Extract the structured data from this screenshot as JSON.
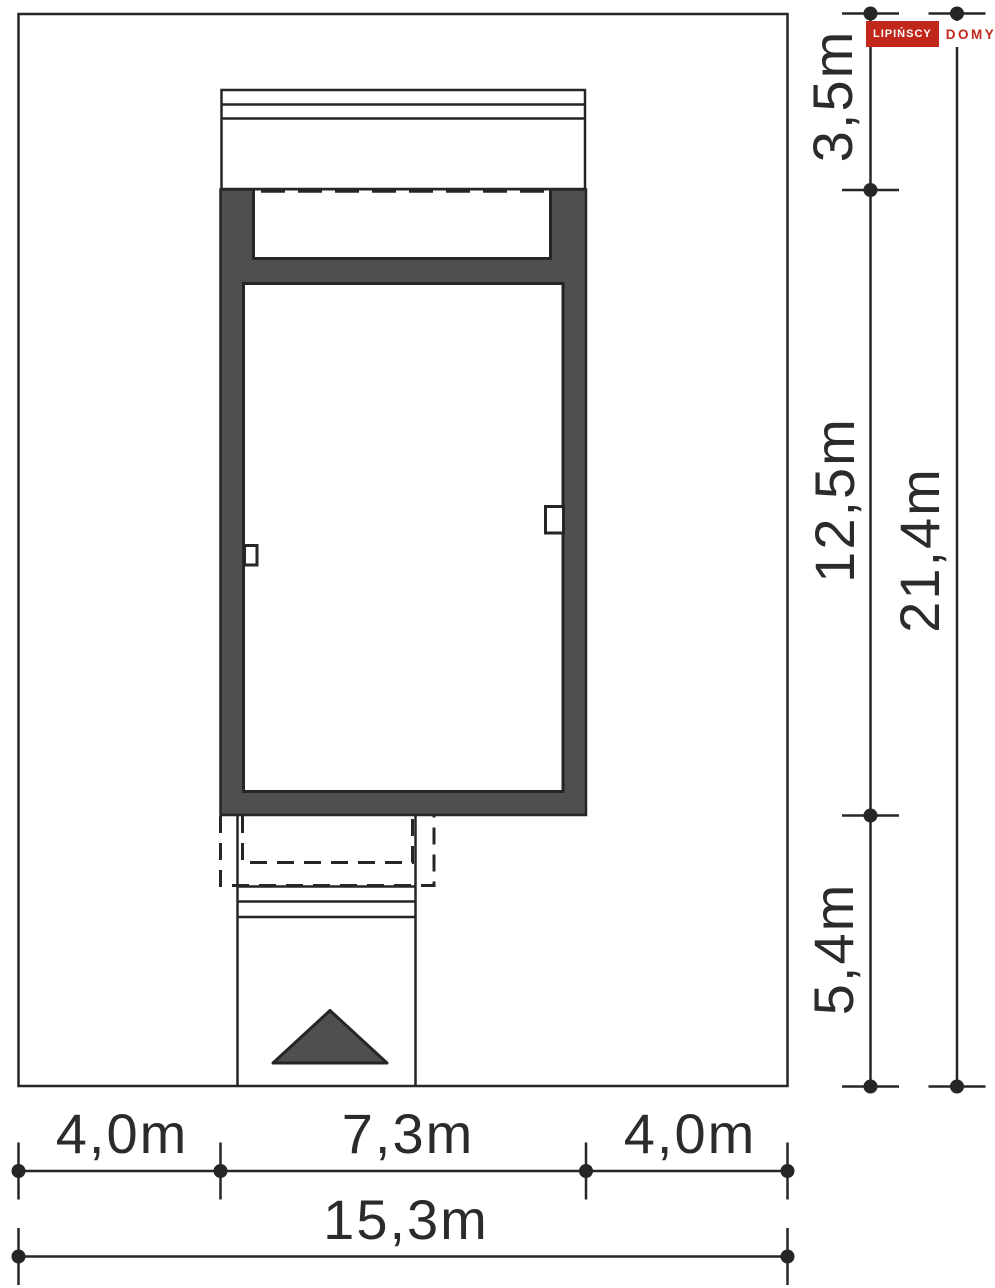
{
  "logo": {
    "brand": "LIPIŃSCY",
    "suffix": "DOMY"
  },
  "dimensions": {
    "right": [
      {
        "label": "3,5m",
        "meters": 3.5,
        "what": "setback plot top edge to house"
      },
      {
        "label": "12,5m",
        "meters": 12.5,
        "what": "house depth"
      },
      {
        "label": "5,4m",
        "meters": 5.4,
        "what": "setback house to plot bottom edge"
      },
      {
        "label": "21,4m",
        "meters": 21.4,
        "what": "total plot depth"
      }
    ],
    "bottom": [
      {
        "label": "4,0m",
        "meters": 4.0,
        "what": "setback left"
      },
      {
        "label": "7,3m",
        "meters": 7.3,
        "what": "house width"
      },
      {
        "label": "4,0m",
        "meters": 4.0,
        "what": "setback right"
      },
      {
        "label": "15,3m",
        "meters": 15.3,
        "what": "total plot width"
      }
    ]
  },
  "symbols": {
    "entrance_arrow": "triangle-up"
  },
  "colors": {
    "wall_fill": "#4f4f4f",
    "line_dark": "#262626",
    "text": "#2b2b2b",
    "logo_red": "#c1271b"
  }
}
